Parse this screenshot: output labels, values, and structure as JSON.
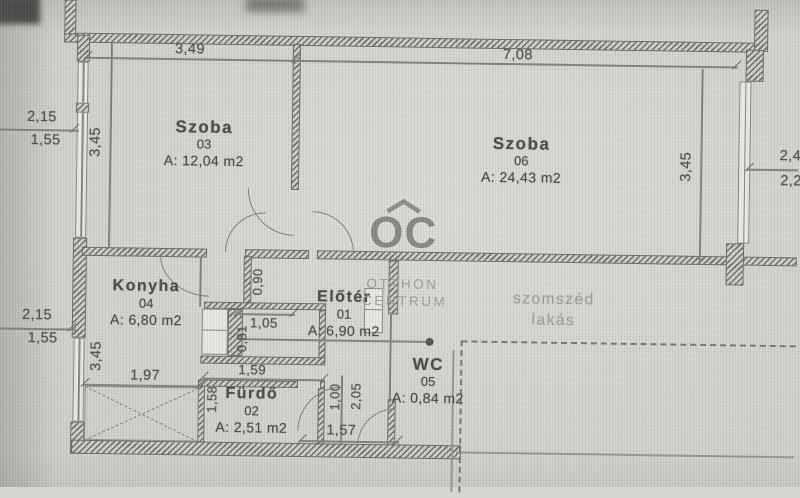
{
  "rooms": [
    {
      "name": "Szoba",
      "number": "03",
      "area": "A: 12,04 m2"
    },
    {
      "name": "Szoba",
      "number": "06",
      "area": "A: 24,43 m2"
    },
    {
      "name": "Konyha",
      "number": "04",
      "area": "A: 6,80 m2"
    },
    {
      "name": "Előtér",
      "number": "01",
      "area": "A: 6,90 m2"
    },
    {
      "name": "WC",
      "number": "05",
      "area": "A: 0,84 m2"
    },
    {
      "name": "Fürdő",
      "number": "02",
      "area": "A: 2,51 m2"
    }
  ],
  "neighbor": {
    "line1": "szomszéd",
    "line2": "lakás"
  },
  "watermark": {
    "logo": "OC",
    "line1": "OTTHON",
    "line2": "CENTRUM"
  },
  "dims": {
    "top_szoba03": "3,49",
    "top_szoba06": "7,08",
    "left_upper_a": "2,15",
    "left_upper_b": "1,55",
    "left_lower_a": "2,15",
    "left_lower_b": "1,55",
    "height_szoba03": "3,45",
    "height_konyha": "3,45",
    "height_szoba06": "3,45",
    "right_a": "2,4",
    "right_b": "2,2",
    "door_width": "0,90",
    "pantry_width": "1,05",
    "pantry_depth": "0,81",
    "furdo_width": "1,59",
    "furdo_depth": "1,58",
    "konyha_width": "1,97",
    "eloter_a": "1,00",
    "eloter_b": "2,05",
    "wc_width": "1,57"
  },
  "colors": {
    "background": "#d6d5d0",
    "wall_hatch": "#73726d",
    "line": "#85847f",
    "text": "#555350",
    "faint_text": "#a7a6a2",
    "watermark": "#8b8a86"
  }
}
